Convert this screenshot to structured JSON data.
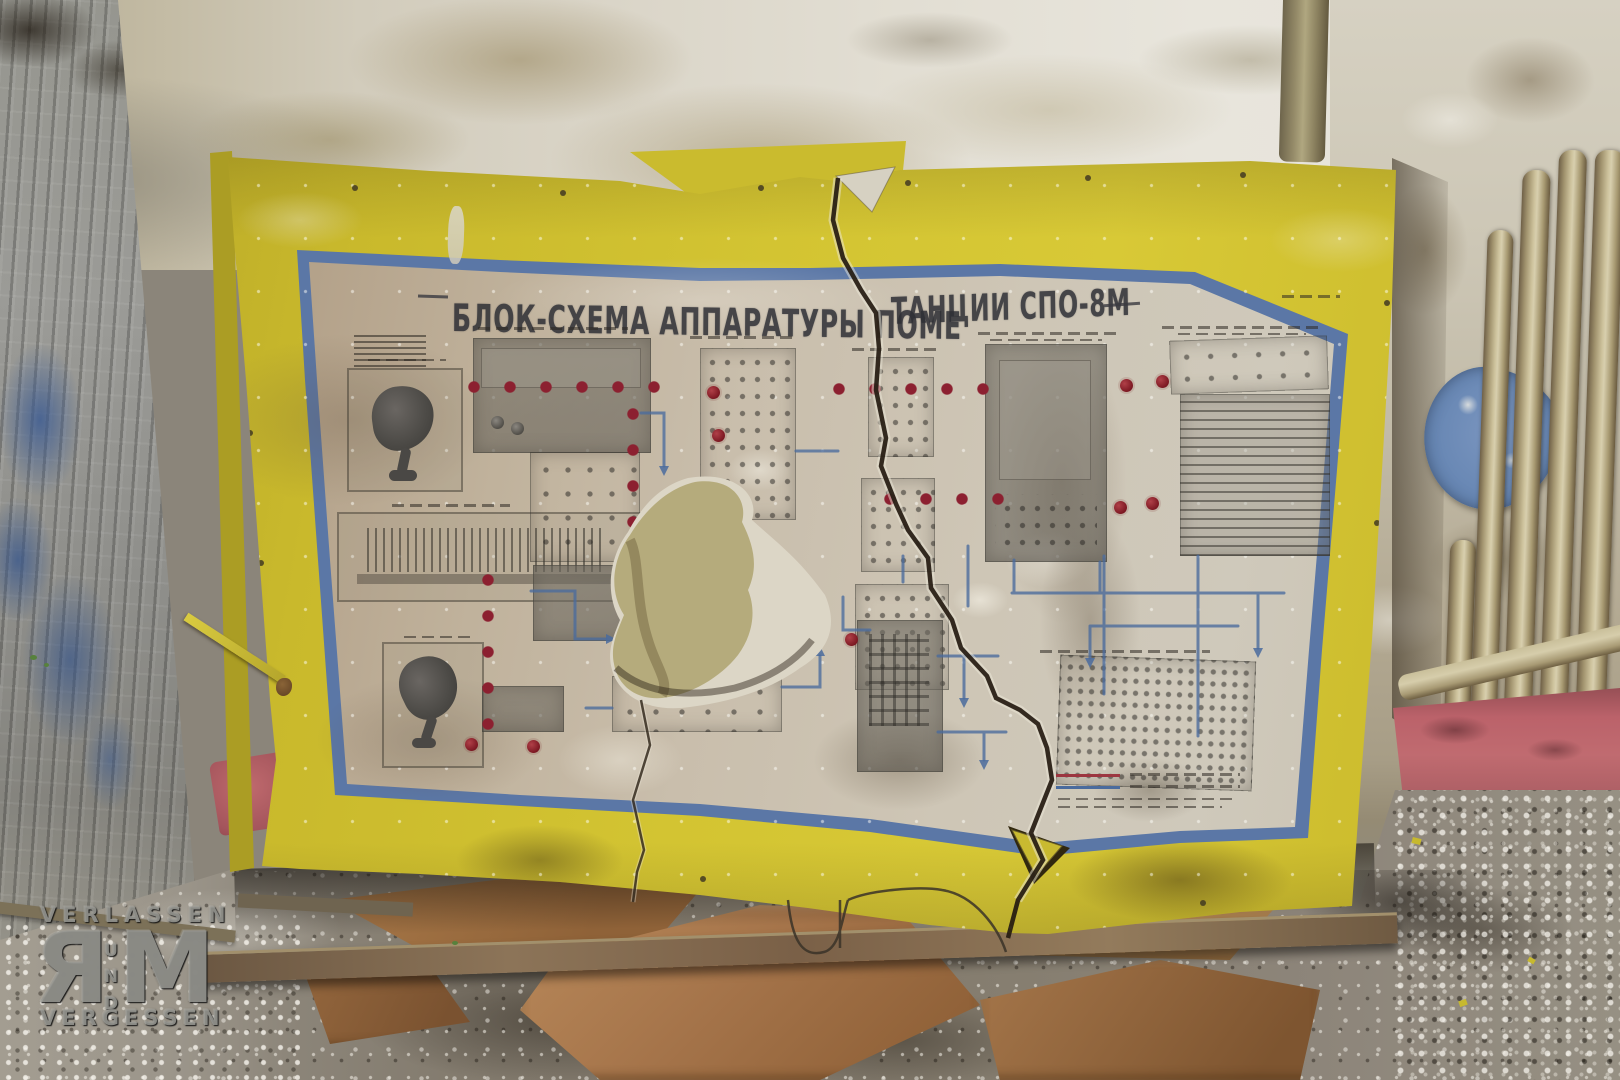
{
  "photo": {
    "subject": "Torn Soviet-era technical wall chart (block diagram of SPO-8M jamming station equipment) leaning against a decayed wall",
    "setting": "abandoned room with peeling paint, radiator pipes, rubble floor, crumpled brown paper and a wooden plank"
  },
  "poster": {
    "title_left": "БЛОК-СХЕМА  АППАРАТУРЫ  ПОМЕ",
    "title_right": "ТАНЦИИ  СПО-8М",
    "title_full": "БЛОК-СХЕМА АППАРАТУРЫ ПОМЕ…ТАНЦИИ СПО-8М"
  },
  "watermark": {
    "top": "VERLASSEN",
    "big_left": "Я",
    "u": "U",
    "n": "N",
    "d": "D",
    "big_right": "M",
    "bottom": "VERGESSEN"
  },
  "palette": {
    "poster_yellow": "#d3c432",
    "frame_blue": "#5b77a6",
    "paper_beige": "#c9beac",
    "red_dot": "#8c2030",
    "line_blue": "#4a6b9d",
    "wall_white": "#e2ded3",
    "wall_grey": "#8f8f8c",
    "wall_blue_paint": "#3d5c92",
    "baseboard_pink": "#b9626a",
    "floor_grey": "#867e71",
    "paper_brown": "#a87848",
    "hole_khaki": "#b5ab7c",
    "crack_dark": "#241a10"
  }
}
